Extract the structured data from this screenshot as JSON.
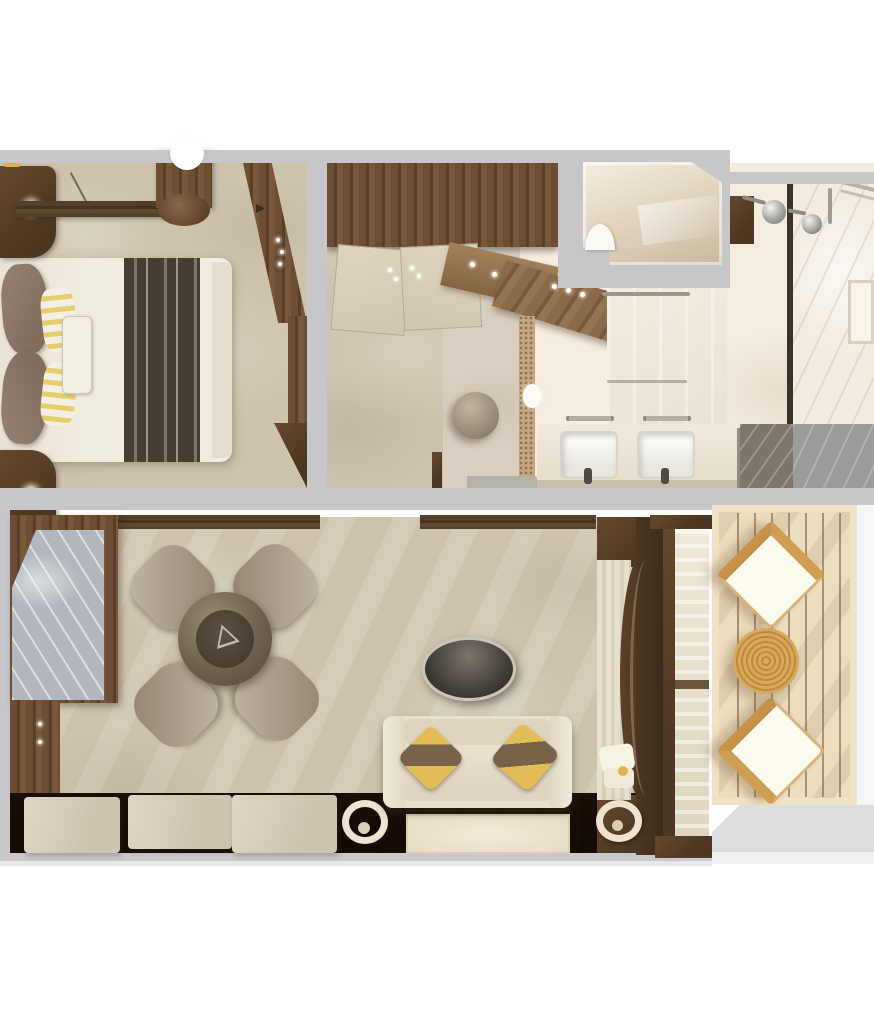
{
  "meta": {
    "type": "floorplan-render",
    "view": "top-down-3d",
    "description": "Photorealistic top-down rendering of a suite floor plan with bedroom, walk-in closet, bathroom, WC, living room and furnished balcony. No text labels are rendered in the image.",
    "text_visible": false
  },
  "palette": {
    "wall_gray": "#c7c7c9",
    "carpet": "#cdc3ad",
    "dark_wood": "#5b432e",
    "wood_floor": "#4a3824",
    "bathroom_floor": "#f3ecdf",
    "marble_counter_gray": "#b3b7bd",
    "shower_floor": "#837b6f",
    "deck_wood": "#ecddbe",
    "rattan": "#cf9a4e",
    "accent_yellow": "#ddb44f",
    "sofa_cream": "#e7e0cd",
    "platform_gray": "#dcddde"
  },
  "rooms": {
    "bedroom": {
      "label": "Bedroom",
      "furniture": [
        "king-bed",
        "bed-runner",
        "leather-pillows",
        "striped-pillows",
        "lumbar-pillow",
        "nightstand-top",
        "nightstand-bottom",
        "wardrobe-beam",
        "wood-column",
        "angled-door-wall"
      ]
    },
    "closet": {
      "label": "Walk-in Closet",
      "furniture": [
        "wardrobe",
        "closet-door-panels",
        "door-hinges"
      ]
    },
    "dressing": {
      "label": "Dressing Area",
      "furniture": [
        "wood-ledge",
        "round-pouf",
        "angled-vanity-counter"
      ]
    },
    "wc": {
      "label": "WC Compartment",
      "furniture": [
        "toilet"
      ]
    },
    "bathroom": {
      "label": "Bathroom",
      "furniture": [
        "double-vanity",
        "sink-left",
        "sink-right",
        "towel-bars",
        "mosaic-strip",
        "bath-mat",
        "glass-shower",
        "rain-shower-heads",
        "shower-window",
        "wood-shelves"
      ]
    },
    "living": {
      "label": "Living Room",
      "furniture": [
        "marble-bar-cabinet",
        "side-cabinet",
        "round-dining-table",
        "dining-chairs-x4",
        "oval-coffee-table",
        "sofa",
        "yellow-pillows-x2",
        "bench-cushions-x3",
        "horseshoe-sculptures-x2",
        "area-rug",
        "media-wall-unit",
        "balcony-glass-door"
      ]
    },
    "balcony": {
      "label": "Balcony",
      "furniture": [
        "rattan-chair-top",
        "rattan-chair-bottom",
        "rattan-round-table",
        "deck-planks",
        "lower-platform"
      ]
    }
  },
  "counts": {
    "dining_chairs": 4,
    "sinks": 2,
    "balcony_chairs": 2,
    "bench_cushions": 3,
    "shower_heads": 2
  }
}
